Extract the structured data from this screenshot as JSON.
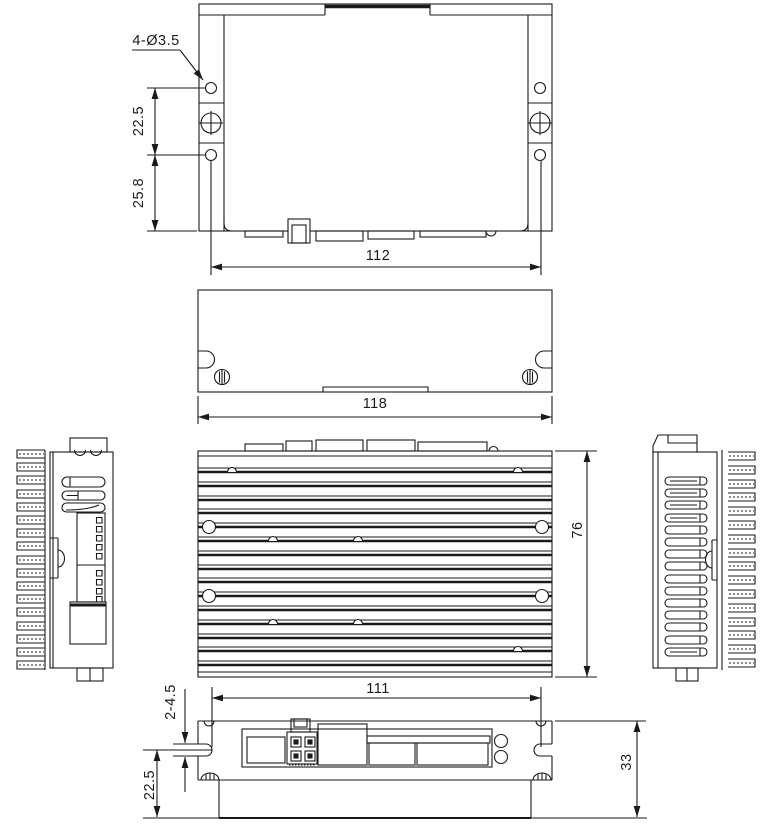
{
  "drawing": {
    "kind": "mechanical outline drawing - six orthographic views of a stepper motor driver with heatsink",
    "line_color": "#1a1a1a",
    "background": "#ffffff",
    "dims": {
      "mounting_hole_callout": "4-Ø3.5",
      "top_hole_pitch": "22.5",
      "top_hole_to_edge": "25.8",
      "top_hole_span": "112",
      "overall_width": "118",
      "overall_depth": "76",
      "front_slot_span": "111",
      "front_slot_callout": "2-4.5",
      "front_slot_to_base": "22.5",
      "overall_height": "33"
    }
  }
}
